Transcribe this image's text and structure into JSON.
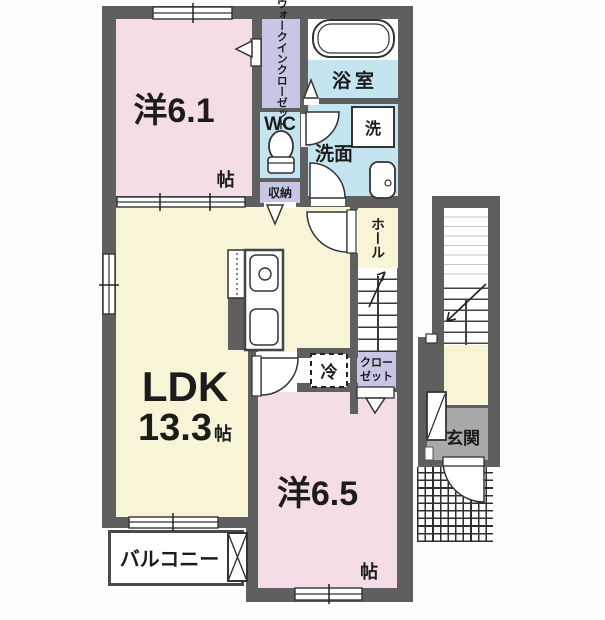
{
  "colors": {
    "wall": "#5f5f5f",
    "room_pink": "#f4dde6",
    "room_cream": "#f8f4d8",
    "room_lavender": "#c8c6e5",
    "room_blue": "#c4e5f0",
    "entrance_gray": "#a9a9a9",
    "line": "#333333"
  },
  "rooms": {
    "bedroom1": {
      "name": "洋6.1",
      "unit": "帖"
    },
    "wic": {
      "line1": "ウォークイン",
      "line2": "クローゼット"
    },
    "bath": {
      "label": "浴室"
    },
    "wc": {
      "label": "WC"
    },
    "washroom": {
      "label": "洗面"
    },
    "laundry": {
      "label": "洗"
    },
    "storage": {
      "label": "収納"
    },
    "hall": {
      "label": "ホール"
    },
    "ldk": {
      "name": "LDK",
      "size": "13.3",
      "unit": "帖"
    },
    "fridge": {
      "label": "冷"
    },
    "closet": {
      "line1": "クロー",
      "line2": "ゼット"
    },
    "bedroom2": {
      "name": "洋6.5",
      "unit": "帖"
    },
    "balcony": {
      "label": "バルコニー"
    },
    "entrance": {
      "label": "玄関"
    }
  }
}
